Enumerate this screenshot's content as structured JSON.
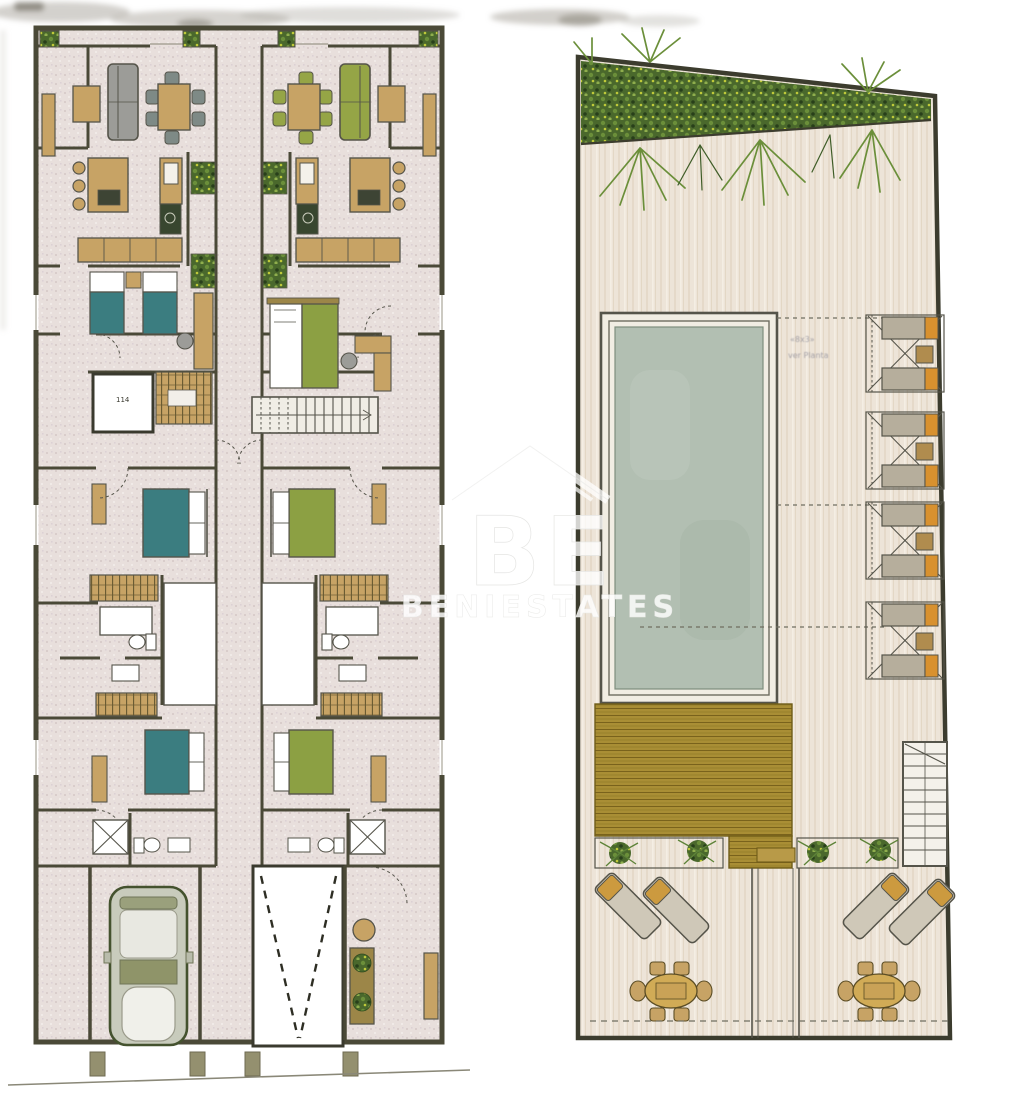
{
  "document": {
    "kind": "scanned architectural floor plan sheet",
    "background": "#ffffff"
  },
  "watermark": {
    "monogram": "BE",
    "name": "BENIESTATES",
    "icon": "house-roof-icon",
    "color": "#ffffff",
    "opacity": 0.8
  },
  "ground_floor_plan": {
    "title": "two-unit duplex plan",
    "elevator_label": "114",
    "shared_features": [
      "central-staircase",
      "light-well-courtyards",
      "street-posts"
    ],
    "units": [
      {
        "id": "unit-a",
        "accent_color": "#3b7d80",
        "rooms": [
          "front-terrace",
          "living-dining",
          "kitchen",
          "twin-bedroom",
          "elevator",
          "double-bedroom",
          "bathroom",
          "laundry",
          "rear-bedroom",
          "shower-room",
          "garage"
        ],
        "furniture": [
          "side-table",
          "gray-sofa",
          "dining-table-6-chairs",
          "island-3-stools",
          "twin-beds",
          "desk-chair",
          "wardrobes",
          "double-bed",
          "toilet",
          "washbasin",
          "shower",
          "car"
        ]
      },
      {
        "id": "unit-b",
        "accent_color": "#8ca043",
        "rooms": [
          "front-terrace",
          "living-dining",
          "kitchen",
          "master-bedroom",
          "double-bedroom",
          "bathroom",
          "laundry",
          "rear-bedroom",
          "shower-room",
          "car-ramp",
          "rear-patio"
        ],
        "furniture": [
          "side-table",
          "green-sofa",
          "dining-table-6-chairs",
          "island-3-stools",
          "double-beds",
          "desk-chair",
          "wardrobes",
          "toilet",
          "washbasin",
          "shower",
          "planted-bench",
          "flower-pot"
        ]
      }
    ]
  },
  "roof_plan": {
    "title": "roof terrace and pool deck",
    "pool_annotation_line1": "«8x3»",
    "pool_annotation_line2": "ver Planta",
    "lounger_pair_count": 4,
    "features": [
      "planted-border",
      "swimming-pool",
      "sun-lounger-pairs",
      "timber-deck",
      "stair-flight",
      "planter-strips",
      "walkway",
      "terrace-loungers",
      "round-dining-tables"
    ]
  },
  "colors": {
    "wall": "#4a4937",
    "ink": "#55544a",
    "floorLeft": "#e8dfdc",
    "floorLeftDot": "#d9cdcb",
    "floorRight": "#ede4d8",
    "floorRightStreak": "#dfd2c0",
    "tan": "#c7a365",
    "tanDark": "#9c8648",
    "tanDeep": "#6b5c33",
    "teal": "#3b7d80",
    "green": "#8ca043",
    "greenChair": "#95a546",
    "sofaGray": "#9c9c98",
    "chairGray": "#7e8a86",
    "pool": "#b2bfb2",
    "poolEdge": "#7e8e7e",
    "poolDeck": "#f1ede3",
    "deck": "#a98e35",
    "deckLine": "#79621c",
    "veg": "#4a682c",
    "vegLight": "#6b8f3a",
    "vegDark": "#283f1a",
    "vegYellow": "#bfca3a",
    "orange": "#d8912f",
    "loungerBody": "#b6ae9c",
    "carBody": "#c8cbbc",
    "carLine": "#44522e",
    "artifact": "#a8a49c"
  }
}
